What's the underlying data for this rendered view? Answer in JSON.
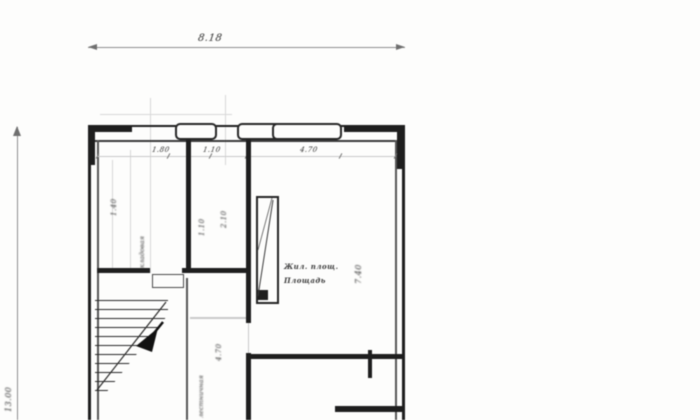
{
  "drawing": {
    "type": "scanned floor plan",
    "dimensions": {
      "top_width": "8.18",
      "left_height": "13.00",
      "segments": [
        "1.80",
        "1.10",
        "4.70"
      ],
      "left_room_depth": "1.40",
      "middle_room_dims": [
        "1.10",
        "2.10"
      ],
      "corridor_dim": "4.70",
      "right_room_height": "7.40"
    },
    "labels": {
      "left_room_vertical": "кладовая",
      "corridor_vertical": "лестничная",
      "right_room_line1": "Жил. площ.",
      "right_room_line2": "Площадь"
    },
    "colors": {
      "paper": "#fdfdfc",
      "wall": "#1e1e1e",
      "dim_line": "#8f8f8f",
      "text": "#2e2e2e"
    }
  }
}
